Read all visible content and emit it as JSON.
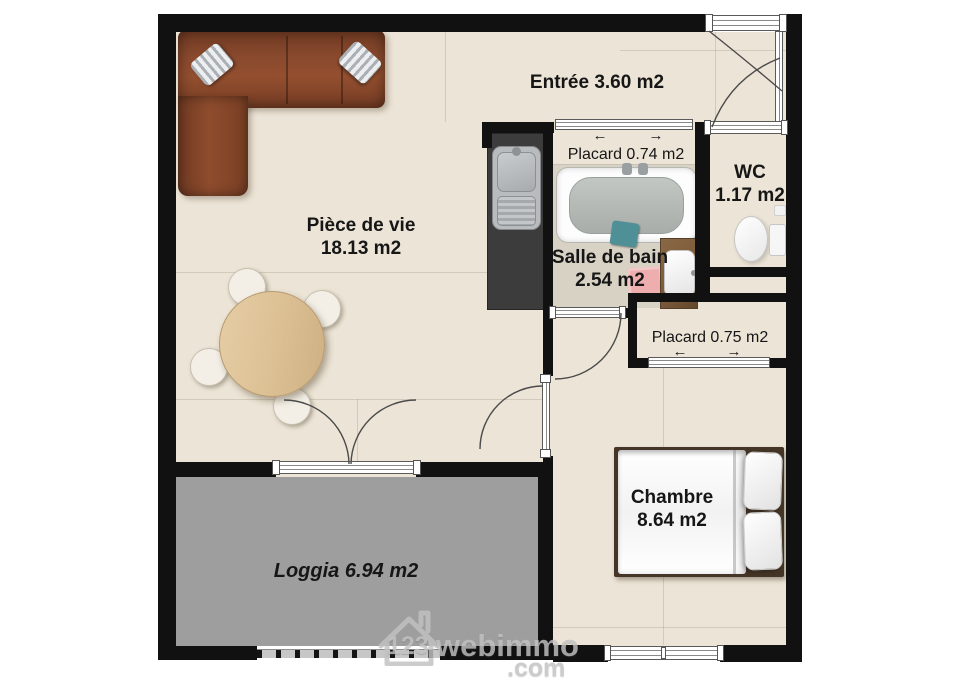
{
  "labels": {
    "entree": "Entrée 3.60 m2",
    "piece_de_vie_name": "Pièce de vie",
    "piece_de_vie_area": "18.13 m2",
    "placard_top": "Placard 0.74 m2",
    "wc_name": "WC",
    "wc_area": "1.17 m2",
    "sdb_name": "Salle de bain",
    "sdb_area": "2.54 m2",
    "placard_bottom": "Placard 0.75 m2",
    "chambre_name": "Chambre",
    "chambre_area": "8.64 m2",
    "loggia": "Loggia 6.94 m2"
  },
  "icons": {
    "slide_left": "←",
    "slide_right": "→"
  },
  "watermark": {
    "number": "123",
    "brand": "webimmo",
    "tld": ".com"
  },
  "colors": {
    "wall": "#111111",
    "floor": "#ece4d6",
    "bath_floor": "#d8d2c5",
    "loggia_floor": "#9e9e9e",
    "sofa": "#8a4a2e",
    "table_wood": "#dcc094",
    "counter": "#3c3c3c",
    "vanity_wood": "#7b5a3a",
    "bath_mat": "#f0abab",
    "towel": "#4f9097",
    "bed_frame": "#443526",
    "label_text": "#161616",
    "door_arc": "#4b4b4b",
    "watermark_grey": "#c2c2c2"
  }
}
